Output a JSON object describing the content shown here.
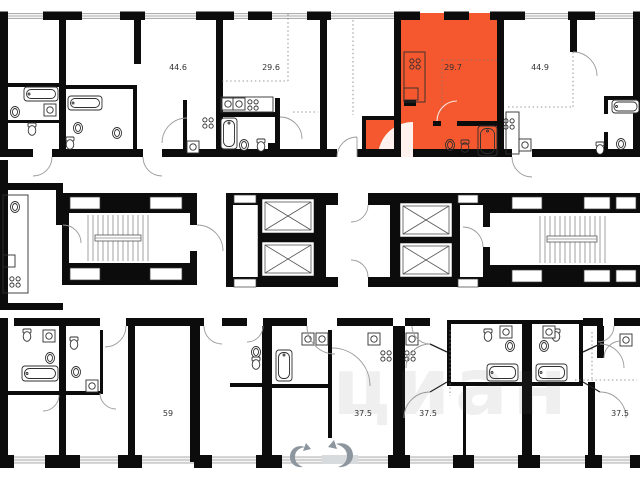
{
  "plan": {
    "type": "apartment-floor-plan",
    "background": "#ffffff",
    "wall_color": "#0c0c0c",
    "highlight_color": "#F5582F",
    "label_color": "#333333",
    "units": [
      {
        "id": "top-left",
        "area_label": "44.6",
        "highlighted": false
      },
      {
        "id": "top-mid-left",
        "area_label": "29.6",
        "highlighted": false
      },
      {
        "id": "top-mid-right",
        "area_label": "29.7",
        "highlighted": true
      },
      {
        "id": "top-right",
        "area_label": "44.9",
        "highlighted": false
      },
      {
        "id": "bottom-left",
        "area_label": "59",
        "highlighted": false
      },
      {
        "id": "bottom-mid-left",
        "area_label": "37.5",
        "highlighted": false
      },
      {
        "id": "bottom-mid",
        "area_label": "37.5",
        "highlighted": false
      },
      {
        "id": "bottom-right",
        "area_label": "37.5",
        "highlighted": false
      }
    ],
    "watermark": {
      "text": "циан",
      "logo": "cian-swirl-logo",
      "color": "rgba(100,100,100,0.10)"
    }
  }
}
